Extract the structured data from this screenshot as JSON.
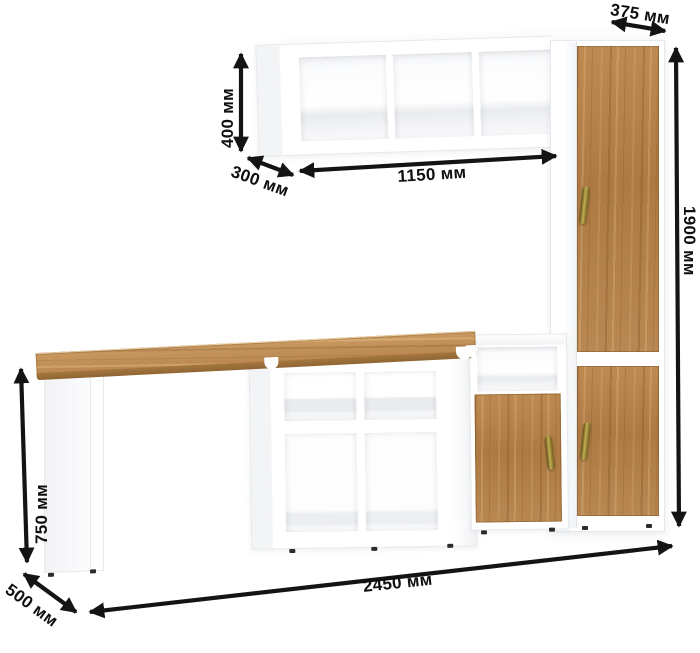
{
  "diagram": {
    "kind": "furniture-dimension-diagram",
    "unit": "мм",
    "dimensions": {
      "depth_top": "375 мм",
      "shelf_height": "400 мм",
      "shelf_depth": "300 мм",
      "shelf_width": "1150 мм",
      "total_height": "1900 мм",
      "desk_height": "750 мм",
      "desk_depth": "500 мм",
      "total_width": "2450 мм"
    },
    "colors": {
      "wood": "#b2804a",
      "wood_edge": "#96703a",
      "carcass": "#ffffff",
      "shade": "#eef0f2",
      "arrow": "#141414",
      "handle_brass": "#8a7a2e",
      "background": "#ffffff"
    }
  }
}
